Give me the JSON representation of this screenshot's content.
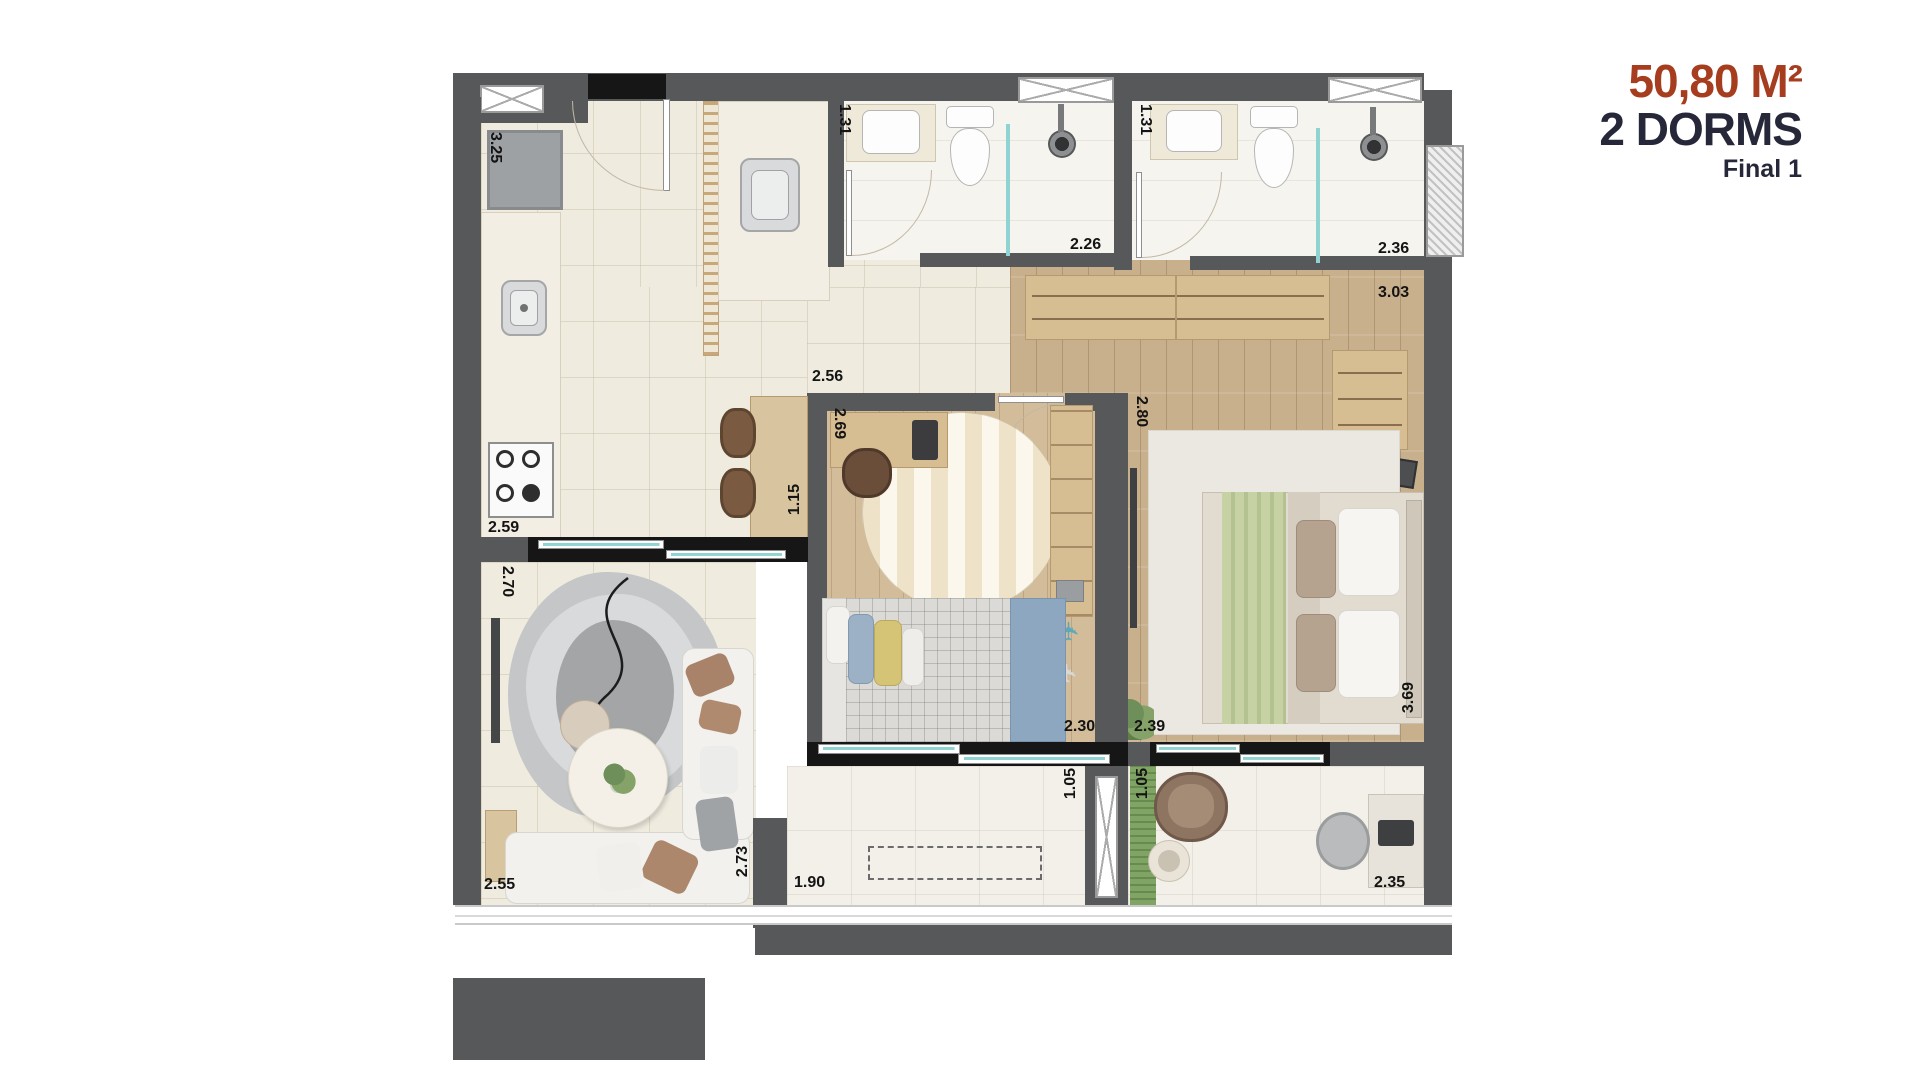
{
  "header": {
    "area": "50,80 M²",
    "dorms": "2 DORMS",
    "final": "Final 1"
  },
  "colors": {
    "accent_rust": "#a63d1e",
    "heading_dark": "#26283a",
    "wall_gray": "#57585a",
    "glass_teal": "#8fd4d2"
  },
  "dims": {
    "kitchen_depth": "3.25",
    "kitchen_width": "2.59",
    "bath1_width": "1.31",
    "bath1_depth": "2.26",
    "bath2_width": "1.31",
    "bath2_depth": "2.36",
    "closet_width": "3.03",
    "bedroom2_width": "2.56",
    "bedroom2_depth": "2.69",
    "dining_width": "1.15",
    "master_depth": "2.80",
    "living_depth": "2.70",
    "living_width": "2.55",
    "living_length": "2.73",
    "bedroom2_bottom": "2.30",
    "master_width": "2.39",
    "master_side": "3.69",
    "terrace1_width": "1.90",
    "terrace1_side": "1.05",
    "terrace2_side": "1.05",
    "terrace2_width": "2.35"
  }
}
